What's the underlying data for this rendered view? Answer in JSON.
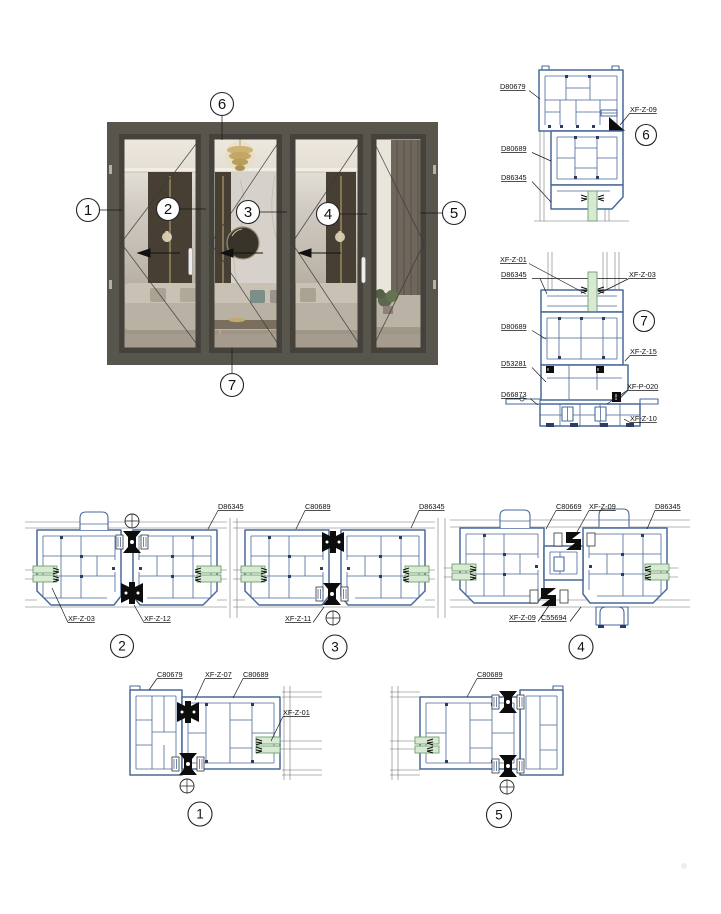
{
  "colors": {
    "profile_stroke": "#4a6a99",
    "profile_accent": "#2c3c62",
    "gasket_fill": "#d8ead2",
    "gasket_stroke": "#6fa070",
    "hardware": "#0d0d0d",
    "annotation": "#1a1a1a",
    "door_frame": "#57554c",
    "door_sash": "#44423b"
  },
  "elevation": {
    "callouts": {
      "c1": "1",
      "c2": "2",
      "c3": "3",
      "c4": "4",
      "c5": "5",
      "c6": "6",
      "c7": "7"
    }
  },
  "details": {
    "d1": {
      "num": "1",
      "labels": {
        "a": "C80679",
        "b": "XF-Z-07",
        "c": "C80689",
        "d": "XF-Z-01"
      }
    },
    "d2": {
      "num": "2",
      "labels": {
        "a": "D86345",
        "b": "XF-Z-03",
        "c": "XF-Z-12"
      }
    },
    "d3": {
      "num": "3",
      "labels": {
        "a": "C80689",
        "b": "D86345",
        "c": "XF-Z-11"
      }
    },
    "d4": {
      "num": "4",
      "labels": {
        "a": "C80669",
        "b": "XF-Z-09",
        "c": "D86345",
        "d": "XF-Z-09",
        "e": "C55694"
      }
    },
    "d5": {
      "num": "5",
      "labels": {
        "a": "C80689"
      }
    },
    "d6": {
      "num": "6",
      "labels": {
        "a": "D80679",
        "b": "XF-Z-09",
        "c": "D80689",
        "d": "D86345"
      }
    },
    "d7": {
      "num": "7",
      "labels": {
        "a": "XF-Z-01",
        "b": "D86345",
        "c": "XF-Z-03",
        "d": "D80689",
        "e": "XF-Z-15",
        "f": "D53281",
        "g": "XF-P-020",
        "h": "D66873",
        "i": "XF-Z-10"
      }
    }
  }
}
